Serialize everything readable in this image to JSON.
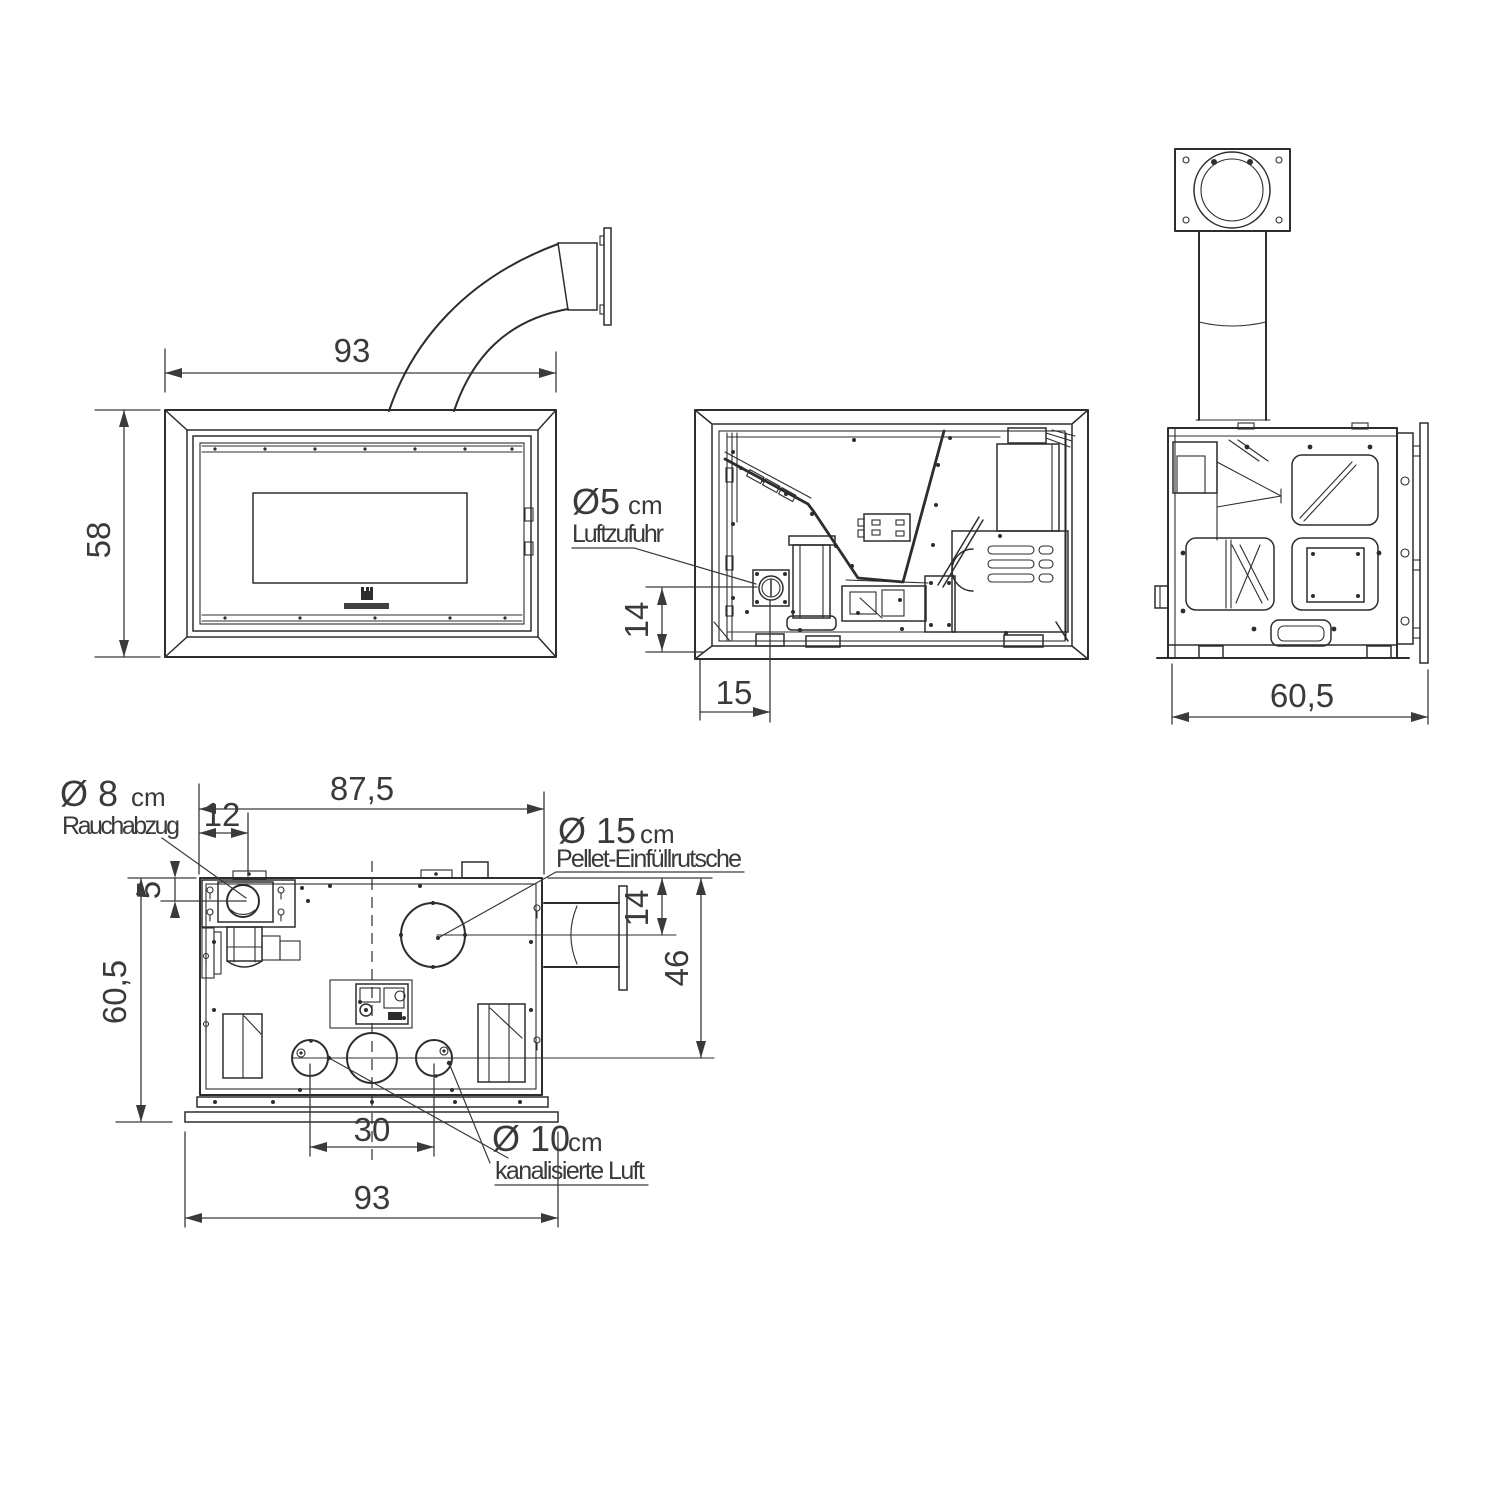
{
  "ink_color": "#2d2d2d",
  "views": {
    "front": {
      "dim_width": "93",
      "dim_height": "58"
    },
    "section": {
      "dim_inlet_height": "14",
      "dim_inlet_offset": "15",
      "air_inlet": {
        "diameter": "Ø5",
        "unit": "cm",
        "label": "Luftzufuhr"
      }
    },
    "side": {
      "dim_depth": "60,5"
    },
    "top": {
      "dim_body_width": "87,5",
      "dim_smoke_x": "12",
      "dim_smoke_y": "5",
      "dim_depth": "60,5",
      "dim_chute_y": "14",
      "dim_ducts_y": "46",
      "dim_duct_spacing": "30",
      "dim_total_width": "93",
      "smoke_outlet": {
        "diameter": "Ø 8",
        "unit": "cm",
        "label": "Rauchabzug"
      },
      "pellet_chute": {
        "diameter": "Ø 15",
        "unit": "cm",
        "label": "Pellet-Einfüllrutsche"
      },
      "ducted_air": {
        "diameter": "Ø 10",
        "unit": "cm",
        "label": "kanalisierte Luft"
      }
    }
  }
}
